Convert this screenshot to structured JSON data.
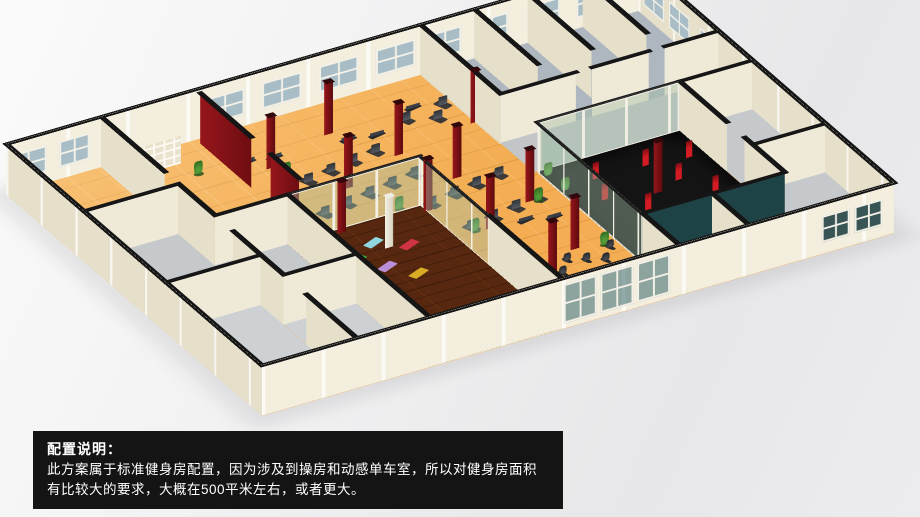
{
  "caption": {
    "title": "配置说明：",
    "body": "此方案属于标准健身房配置，因为涉及到操房和动感单车室，所以对健身房面积有比较大的要求，大概在500平米左右，或者更大。"
  },
  "palette": {
    "background_gray": "#ececee",
    "caption_bg": "#141414",
    "caption_fg": "#ffffff",
    "wall_cream": "#f3eedd",
    "wall_cap_black": "#151515",
    "accent_red_wall": "#8c1216",
    "pillar_red": "#8c151a",
    "window_glass_blue": "#a9bdc6",
    "facade_glass_teal": "#28585e",
    "wood_floor_orange": "#f4ad52",
    "aerobics_floor_brown": "#57280f",
    "boxing_floor_black": "#141414",
    "room_floor_gray": "#c6c9cb",
    "teal_wall": "#1e4347",
    "punching_bag_red": "#d21b22",
    "plant_green": "#3f8a2c"
  },
  "scene": {
    "plan": {
      "w": 1000,
      "h": 700,
      "wall_h": 80
    },
    "floors": [
      {
        "name": "floor-main-gym",
        "x": 0,
        "y": 0,
        "w": 1000,
        "h": 700,
        "kind": "wood"
      },
      {
        "name": "floor-left-room-a",
        "x": 0,
        "y": 212,
        "w": 150,
        "h": 225,
        "kind": "gray1"
      },
      {
        "name": "floor-left-room-b",
        "x": 0,
        "y": 437,
        "w": 150,
        "h": 263,
        "kind": "gray2"
      },
      {
        "name": "floor-small-room-a",
        "x": 150,
        "y": 312,
        "w": 115,
        "h": 188,
        "kind": "gray1"
      },
      {
        "name": "floor-small-room-b",
        "x": 150,
        "y": 500,
        "w": 115,
        "h": 200,
        "kind": "gray2"
      },
      {
        "name": "floor-aerobics-room",
        "x": 265,
        "y": 312,
        "w": 210,
        "h": 388,
        "kind": "brown"
      },
      {
        "name": "floor-boxing-room",
        "x": 660,
        "y": 312,
        "w": 225,
        "h": 288,
        "kind": "dark"
      },
      {
        "name": "floor-top-right-rooms",
        "x": 655,
        "y": 0,
        "w": 345,
        "h": 219,
        "kind": "grayblue"
      },
      {
        "name": "floor-corridor",
        "x": 655,
        "y": 219,
        "w": 345,
        "h": 93,
        "kind": "gray3"
      },
      {
        "name": "floor-right-rooms",
        "x": 885,
        "y": 312,
        "w": 115,
        "h": 388,
        "kind": "gray1"
      },
      {
        "name": "floor-bottom-rooms",
        "x": 660,
        "y": 600,
        "w": 225,
        "h": 100,
        "kind": "gray2"
      }
    ],
    "walls": [
      {
        "x": 0,
        "y": 0,
        "len": 1000,
        "dir": "x",
        "type": "ext",
        "win": [
          [
            6,
            58
          ],
          [
            84,
            48
          ],
          [
            315,
            62
          ],
          [
            405,
            62
          ],
          [
            495,
            62
          ],
          [
            585,
            62
          ],
          [
            668,
            52
          ],
          [
            742,
            52
          ],
          [
            824,
            52
          ],
          [
            902,
            52
          ]
        ]
      },
      {
        "x": 0,
        "y": 700,
        "len": 1000,
        "dir": "x",
        "type": "ext",
        "win": [
          [
            478,
            52,
            "glass2"
          ],
          [
            536,
            52,
            "glass2"
          ],
          [
            594,
            52,
            "glass2"
          ],
          [
            886,
            44,
            "dark"
          ],
          [
            938,
            44,
            "dark"
          ]
        ]
      },
      {
        "x": 0,
        "y": 0,
        "len": 700,
        "dir": "y",
        "type": "ext"
      },
      {
        "x": 1000,
        "y": 0,
        "len": 700,
        "dir": "y",
        "type": "ext",
        "win": [
          [
            14,
            56
          ],
          [
            84,
            56
          ],
          [
            168,
            40
          ]
        ]
      },
      {
        "x": 150,
        "y": 0,
        "len": 175,
        "dir": "y",
        "type": "int"
      },
      {
        "x": 0,
        "y": 212,
        "len": 150,
        "dir": "x",
        "type": "int"
      },
      {
        "x": 0,
        "y": 437,
        "len": 150,
        "dir": "x",
        "type": "int"
      },
      {
        "x": 150,
        "y": 212,
        "len": 100,
        "dir": "y",
        "type": "int"
      },
      {
        "x": 150,
        "y": 362,
        "len": 138,
        "dir": "y",
        "type": "int"
      },
      {
        "x": 150,
        "y": 562,
        "len": 138,
        "dir": "y",
        "type": "int"
      },
      {
        "x": 150,
        "y": 312,
        "len": 115,
        "dir": "x",
        "type": "int"
      },
      {
        "x": 150,
        "y": 500,
        "len": 115,
        "dir": "x",
        "type": "int"
      },
      {
        "x": 300,
        "y": 12,
        "len": 140,
        "dir": "y",
        "type": "red"
      },
      {
        "x": 300,
        "y": 205,
        "len": 78,
        "dir": "y",
        "type": "red"
      },
      {
        "x": 265,
        "y": 312,
        "len": 210,
        "dir": "x",
        "type": "glass"
      },
      {
        "x": 265,
        "y": 312,
        "len": 388,
        "dir": "y",
        "type": "int"
      },
      {
        "x": 475,
        "y": 312,
        "len": 188,
        "dir": "y",
        "type": "glass"
      },
      {
        "x": 475,
        "y": 500,
        "len": 200,
        "dir": "y",
        "type": "int"
      },
      {
        "x": 655,
        "y": 0,
        "len": 219,
        "dir": "y",
        "type": "int"
      },
      {
        "x": 740,
        "y": 0,
        "len": 175,
        "dir": "y",
        "type": "int"
      },
      {
        "x": 825,
        "y": 0,
        "len": 175,
        "dir": "y",
        "type": "int"
      },
      {
        "x": 912,
        "y": 0,
        "len": 175,
        "dir": "y",
        "type": "int"
      },
      {
        "x": 655,
        "y": 219,
        "len": 120,
        "dir": "x",
        "type": "int"
      },
      {
        "x": 800,
        "y": 219,
        "len": 90,
        "dir": "x",
        "type": "int"
      },
      {
        "x": 915,
        "y": 219,
        "len": 85,
        "dir": "x",
        "type": "int"
      },
      {
        "x": 660,
        "y": 312,
        "len": 225,
        "dir": "x",
        "type": "glass"
      },
      {
        "x": 660,
        "y": 312,
        "len": 288,
        "dir": "y",
        "type": "glass"
      },
      {
        "x": 660,
        "y": 600,
        "len": 225,
        "dir": "x",
        "type": "teal"
      },
      {
        "x": 885,
        "y": 312,
        "len": 130,
        "dir": "y",
        "type": "int"
      },
      {
        "x": 885,
        "y": 490,
        "len": 110,
        "dir": "y",
        "type": "int"
      },
      {
        "x": 885,
        "y": 312,
        "len": 115,
        "dir": "x",
        "type": "int"
      },
      {
        "x": 885,
        "y": 512,
        "len": 115,
        "dir": "x",
        "type": "int"
      },
      {
        "x": 770,
        "y": 600,
        "len": 100,
        "dir": "y",
        "type": "int"
      },
      {
        "x": 660,
        "y": 600,
        "len": 100,
        "dir": "y",
        "type": "int"
      }
    ],
    "red_pillars": [
      [
        350,
        119
      ],
      [
        465,
        78
      ],
      [
        415,
        219
      ],
      [
        520,
        175
      ],
      [
        345,
        322
      ],
      [
        478,
        328
      ],
      [
        558,
        269
      ],
      [
        612,
        375
      ],
      [
        528,
        412
      ],
      [
        655,
        150
      ],
      [
        540,
        562
      ],
      [
        600,
        519
      ],
      [
        775,
        444
      ]
    ],
    "white_pillars": [
      [
        380,
        390
      ]
    ],
    "punching_bags": [
      [
        718,
        372
      ],
      [
        700,
        428
      ],
      [
        738,
        481
      ],
      [
        758,
        531
      ],
      [
        795,
        375
      ],
      [
        815,
        431
      ],
      [
        842,
        485
      ],
      [
        858,
        385
      ]
    ],
    "yoga_mats": [
      {
        "x": 300,
        "y": 356,
        "c": "#2b4bd8"
      },
      {
        "x": 325,
        "y": 398,
        "c": "#38b43c"
      },
      {
        "x": 352,
        "y": 435,
        "c": "#bb8fd8"
      },
      {
        "x": 380,
        "y": 472,
        "c": "#d8ac25"
      },
      {
        "x": 368,
        "y": 369,
        "c": "#8fd8e0"
      },
      {
        "x": 408,
        "y": 398,
        "c": "#d03344"
      }
    ],
    "machines": [
      [
        335,
        187
      ],
      [
        375,
        179
      ],
      [
        415,
        171
      ],
      [
        455,
        163
      ],
      [
        495,
        155
      ],
      [
        350,
        268
      ],
      [
        390,
        260
      ],
      [
        430,
        252
      ],
      [
        470,
        244
      ],
      [
        510,
        236
      ],
      [
        490,
        318
      ],
      [
        530,
        310
      ],
      [
        570,
        302
      ],
      [
        610,
        294
      ],
      [
        505,
        400
      ],
      [
        545,
        392
      ],
      [
        585,
        384
      ],
      [
        625,
        376
      ],
      [
        575,
        100
      ],
      [
        615,
        118
      ],
      [
        640,
        88
      ]
    ],
    "benches": [
      [
        330,
        90
      ],
      [
        368,
        98
      ],
      [
        480,
        106
      ],
      [
        520,
        115
      ],
      [
        600,
        75
      ],
      [
        580,
        419
      ],
      [
        618,
        431
      ]
    ],
    "spin_bikes": [
      [
        505,
        545
      ],
      [
        528,
        558
      ],
      [
        551,
        571
      ],
      [
        574,
        543
      ],
      [
        597,
        556
      ],
      [
        620,
        569
      ],
      [
        643,
        541
      ]
    ],
    "treadmills": [
      [
        470,
        640
      ],
      [
        495,
        648
      ],
      [
        520,
        656
      ],
      [
        545,
        644
      ],
      [
        570,
        652
      ],
      [
        595,
        660
      ],
      [
        620,
        648
      ],
      [
        643,
        655
      ]
    ],
    "plants": [
      [
        18,
        72
      ],
      [
        56,
        178
      ],
      [
        255,
        85
      ],
      [
        358,
        148
      ],
      [
        445,
        306
      ],
      [
        505,
        410
      ],
      [
        622,
        381
      ],
      [
        668,
        328
      ],
      [
        668,
        375
      ],
      [
        640,
        531
      ]
    ],
    "shelf": {
      "x": 158,
      "y": 6,
      "w": 92,
      "d": 40
    }
  }
}
